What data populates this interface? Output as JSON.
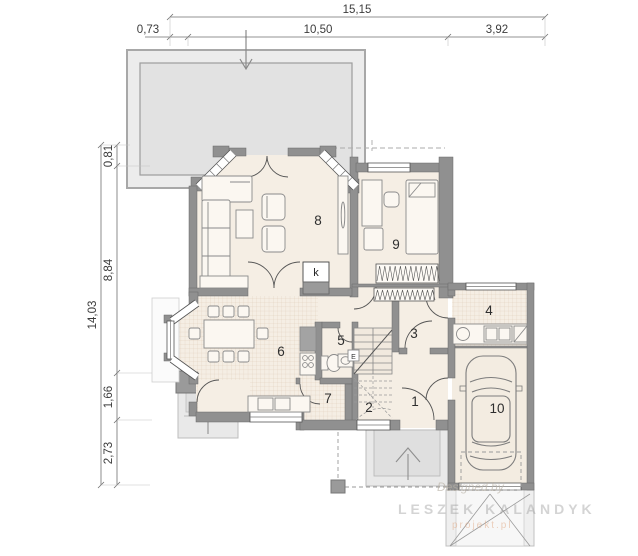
{
  "dimensions": {
    "top_total": "15,15",
    "top_segments": [
      "0,73",
      "10,50",
      "3,92"
    ],
    "left_total": "14,03",
    "left_segments": [
      "0,81",
      "8,84",
      "1,66",
      "2,73"
    ]
  },
  "rooms": {
    "r1": "1",
    "r2": "2",
    "r3": "3",
    "r4": "4",
    "r5": "5",
    "r6": "6",
    "r7": "7",
    "r8": "8",
    "r9": "9",
    "r10": "10"
  },
  "symbols": {
    "fireplace": "k",
    "electric_box": "E"
  },
  "watermark": {
    "byline": "Designed by",
    "author": "LESZEK KALANDYK",
    "website": "projekt.pl"
  },
  "colors": {
    "wall": "#909090",
    "floor": "#f5eee4",
    "tile_grid": "#dcc9b4",
    "terrace": "#e8e8e8",
    "dimension_text": "#3c3c3c"
  }
}
